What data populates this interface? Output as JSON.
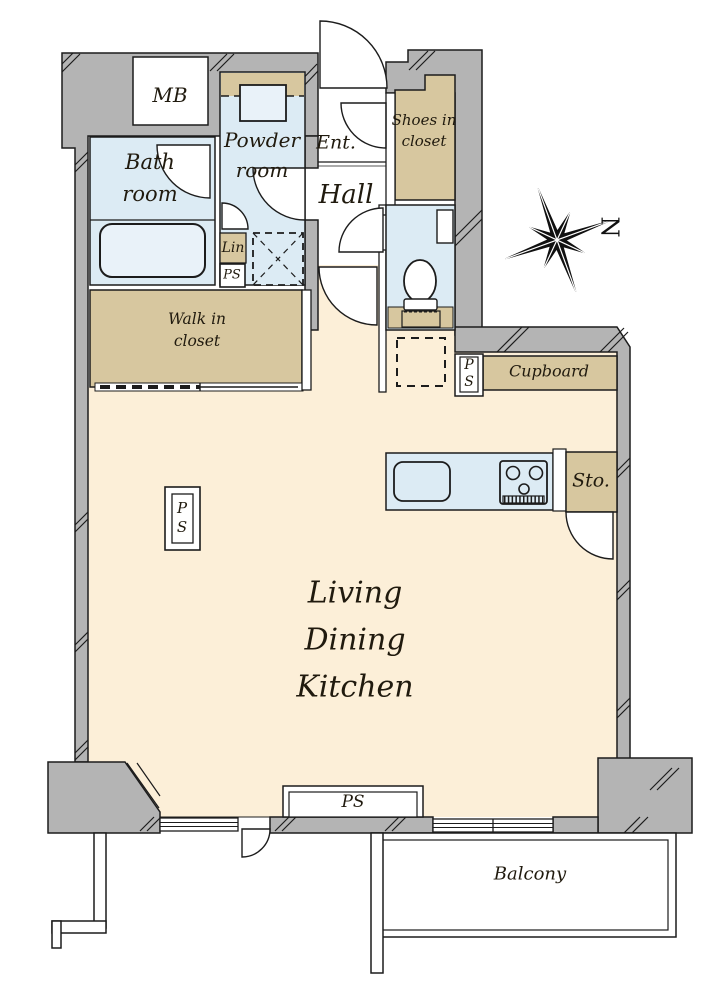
{
  "colors": {
    "wall_gray": "#b4b4b4",
    "floor_cream": "#fcefd8",
    "wet_area_blue": "#dcebf4",
    "fixture_blue": "#e9f2f9",
    "closet_tan": "#d7c79f",
    "line_black": "#1c1c1c",
    "text": "#201a0e"
  },
  "rooms": {
    "meter_box": {
      "label": "MB"
    },
    "bathroom": {
      "line1": "Bath",
      "line2": "room"
    },
    "powder_room": {
      "line1": "Powder",
      "line2": "room"
    },
    "entrance": {
      "label": "Ent."
    },
    "hall": {
      "label": "Hall"
    },
    "shoes_closet": {
      "line1": "Shoes in",
      "line2": "closet"
    },
    "linen": {
      "label": "Lin"
    },
    "walk_in_closet": {
      "line1": "Walk in",
      "line2": "closet"
    },
    "cupboard": {
      "label": "Cupboard"
    },
    "storage": {
      "label": "Sto."
    },
    "ldk": {
      "line1": "Living",
      "line2": "Dining",
      "line3": "Kitchen"
    },
    "balcony": {
      "label": "Balcony"
    }
  },
  "pipe_spaces": {
    "powder_ps": {
      "label": "PS"
    },
    "kitchen_ps": {
      "line1": "P",
      "line2": "S"
    },
    "living_ps": {
      "line1": "P",
      "line2": "S"
    },
    "bottom_ps": {
      "label": "PS"
    }
  },
  "compass": {
    "label": "N"
  }
}
